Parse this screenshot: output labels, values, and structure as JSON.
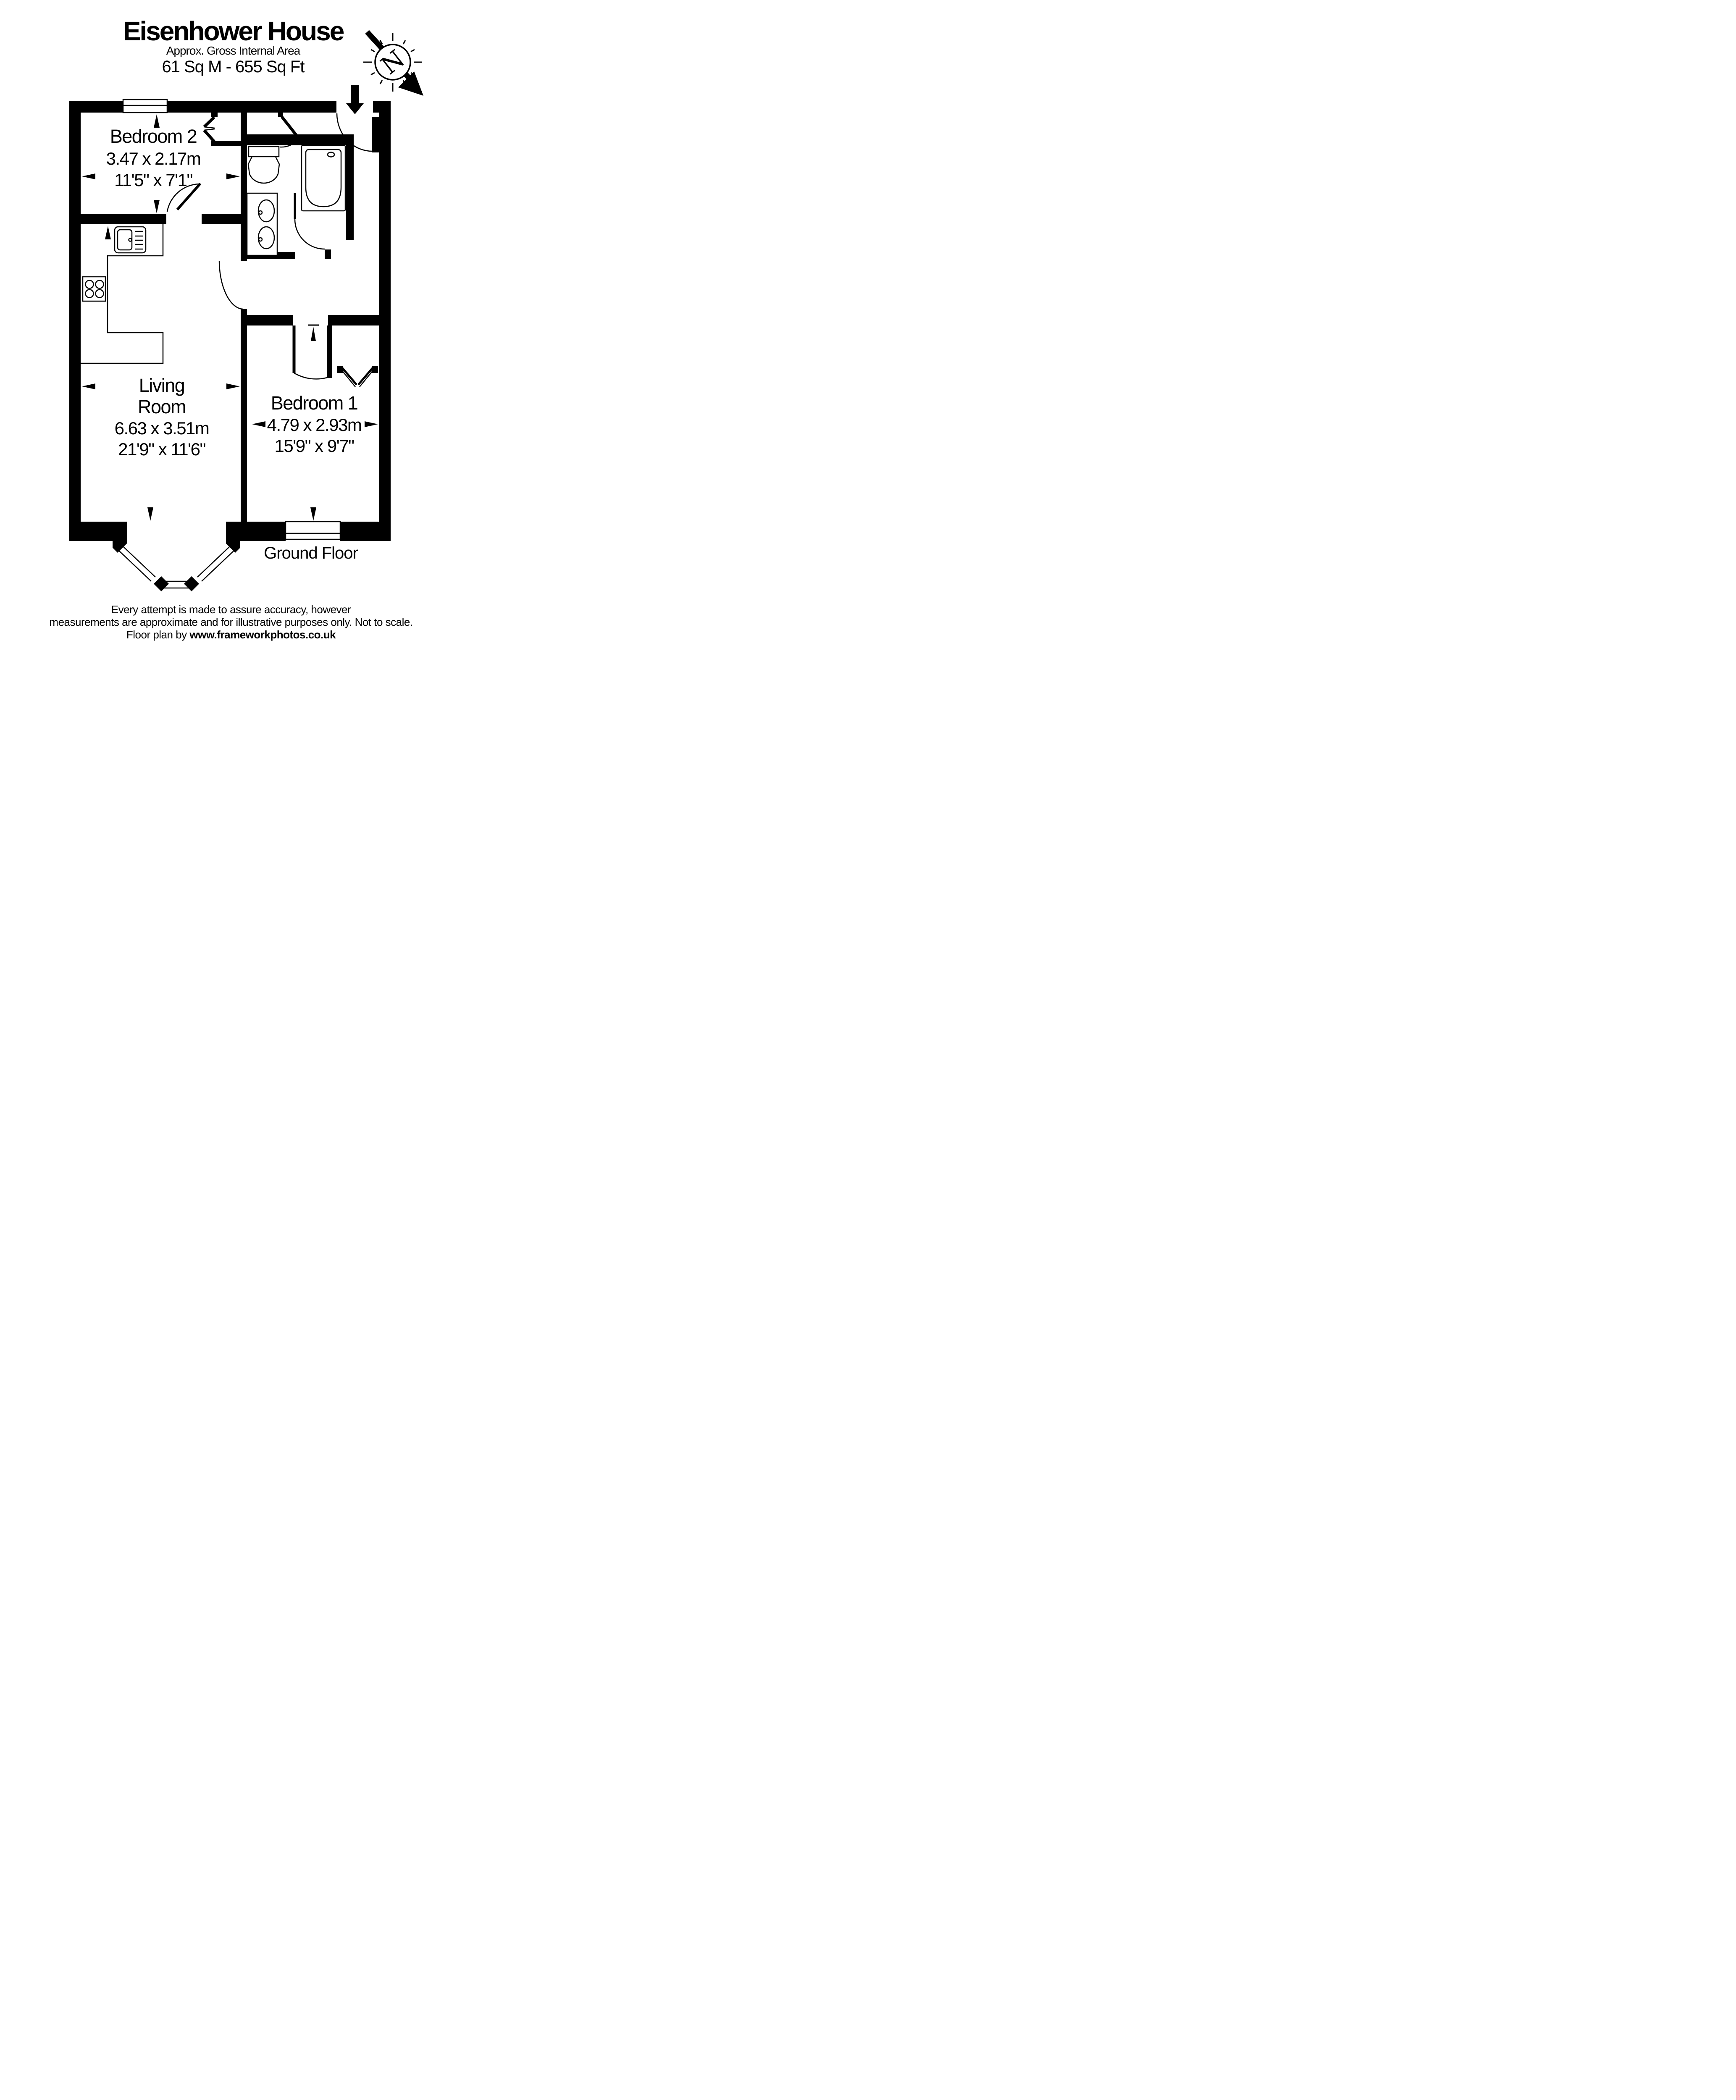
{
  "colors": {
    "ink": "#000000",
    "paper": "#ffffff"
  },
  "header": {
    "title": "Eisenhower House",
    "subtitle": "Approx. Gross Internal Area",
    "area": "61 Sq M  -  655 Sq Ft"
  },
  "compass": {
    "letter": "N"
  },
  "rooms": [
    {
      "id": "bedroom2",
      "name": "Bedroom 2",
      "metric": "3.47 x 2.17m",
      "imperial": "11'5\" x 7'1\""
    },
    {
      "id": "living-room",
      "name_lines": [
        "Living",
        "Room"
      ],
      "metric": "6.63 x 3.51m",
      "imperial": "21'9\" x 11'6\""
    },
    {
      "id": "bedroom1",
      "name": "Bedroom 1",
      "metric": "4.79 x 2.93m",
      "imperial": "15'9\" x 9'7\""
    }
  ],
  "floor_label": "Ground Floor",
  "footer": {
    "line1": "Every attempt is made to assure accuracy, however",
    "line2": "measurements are approximate and for illustrative purposes only. Not to scale.",
    "line3_prefix": "Floor plan by ",
    "line3_site": "www.frameworkphotos.co.uk"
  }
}
